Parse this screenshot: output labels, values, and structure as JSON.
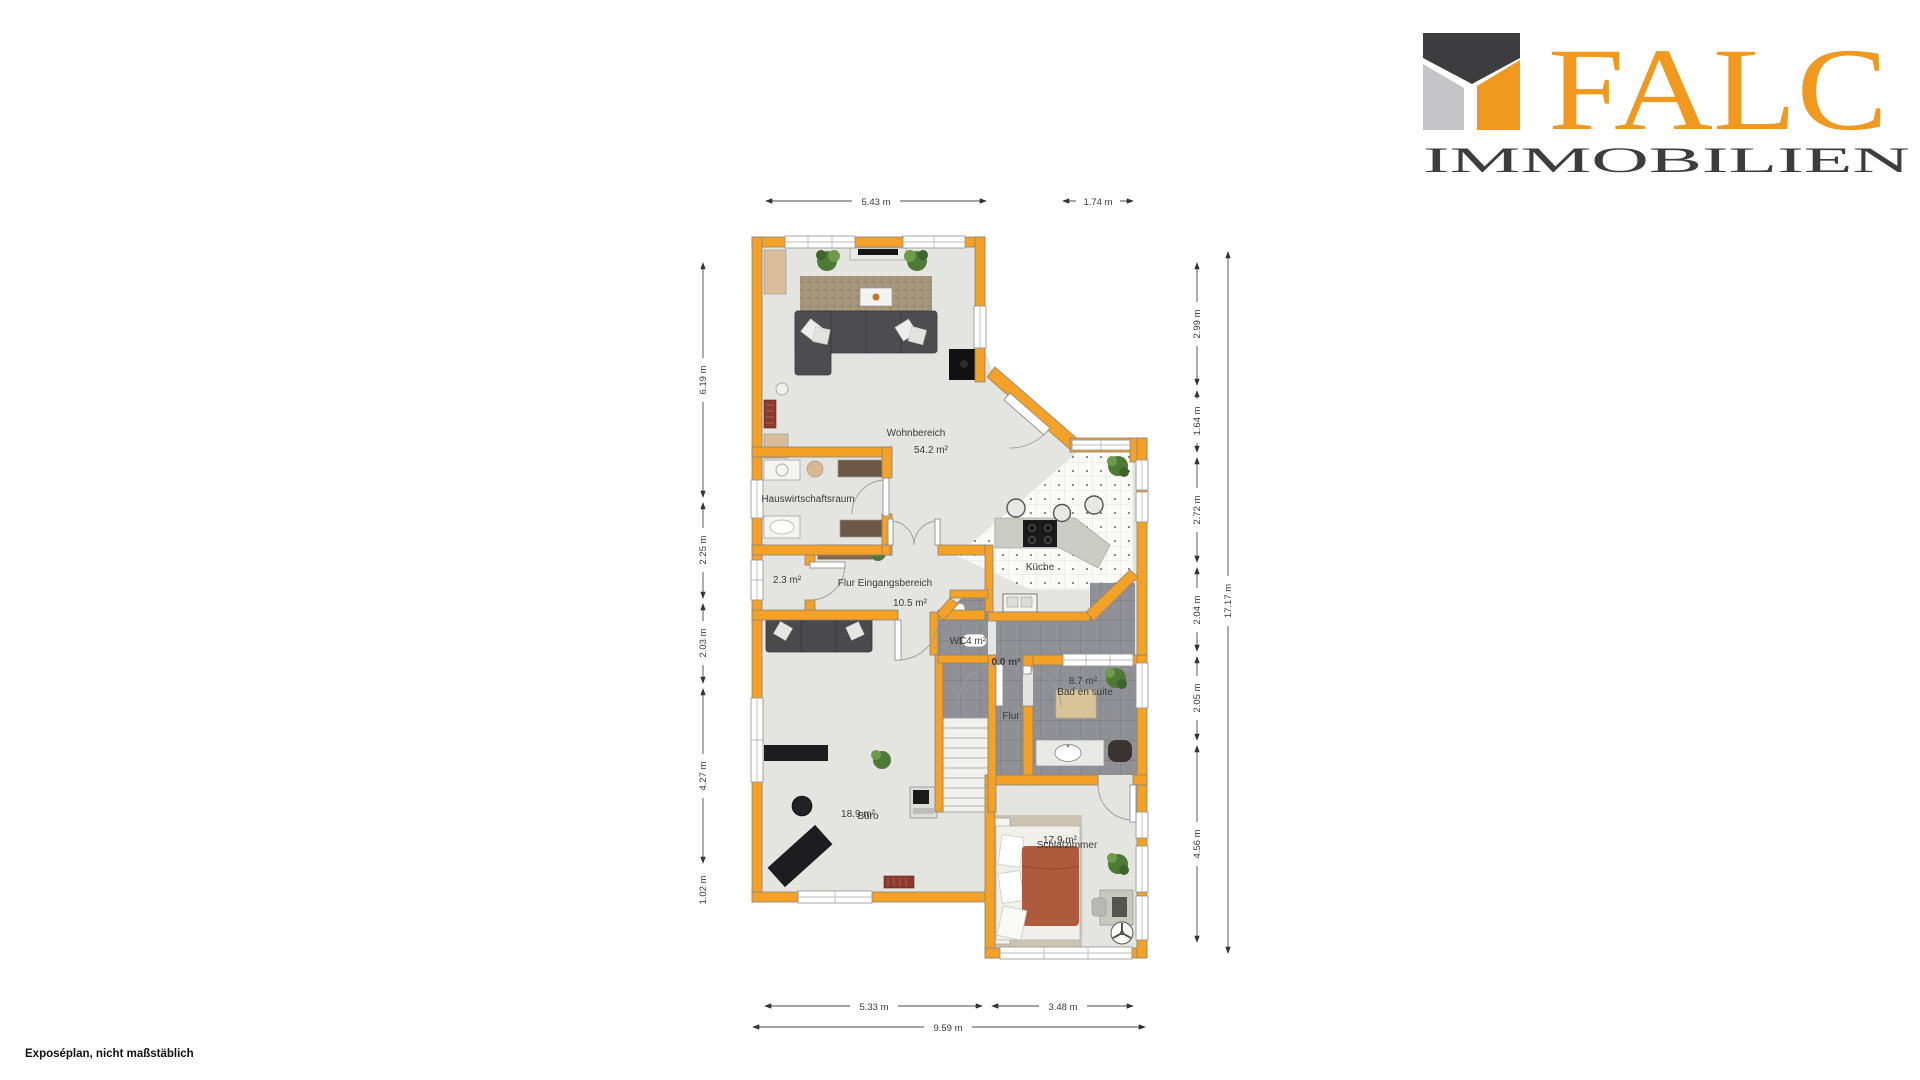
{
  "page": {
    "background": "#FFFFFF",
    "footer_note": "Exposéplan, nicht maßstäblich"
  },
  "logo": {
    "brand": "FALC",
    "subtitle": "IMMOBILIEN",
    "orange": "#F0991E",
    "dark": "#3D3D3F",
    "gray": "#C5C5C7"
  },
  "plan": {
    "wall_color": "#F4A127",
    "rooms": {
      "wohnbereich": {
        "label": "Wohnbereich",
        "area": "54.2 m²"
      },
      "kueche": {
        "label": "Küche"
      },
      "hauswirtschaftsraum": {
        "label": "Hauswirtschaftsraum"
      },
      "abstellraum": {
        "area": "2.3 m²"
      },
      "flur_eingang": {
        "label": "Flur Eingangsbereich",
        "area": "10.5 m²"
      },
      "wc": {
        "label": "WC",
        "area": "1.4 m²"
      },
      "niche": {
        "area": "0.0 m²"
      },
      "flur": {
        "label": "Flur"
      },
      "bad": {
        "label": "Bad en suite",
        "area": "8.7 m²"
      },
      "schlafzimmer": {
        "label": "Schlafzimmer",
        "area": "17.9 m²"
      },
      "buero": {
        "label": "Büro",
        "area": "18.9 m²"
      }
    },
    "dimensions": {
      "top": [
        "5.43 m",
        "1.74 m"
      ],
      "left": [
        "6.19 m",
        "2.25 m",
        "2.03 m",
        "4.27 m",
        "1.02 m"
      ],
      "right": [
        "2.99 m",
        "1.64 m",
        "2.72 m",
        "2.04 m",
        "2.05 m",
        "4.56 m"
      ],
      "right_total": "17.17 m",
      "bottom": [
        "5.33 m",
        "3.48 m"
      ],
      "bottom_total": "9.59 m"
    }
  }
}
